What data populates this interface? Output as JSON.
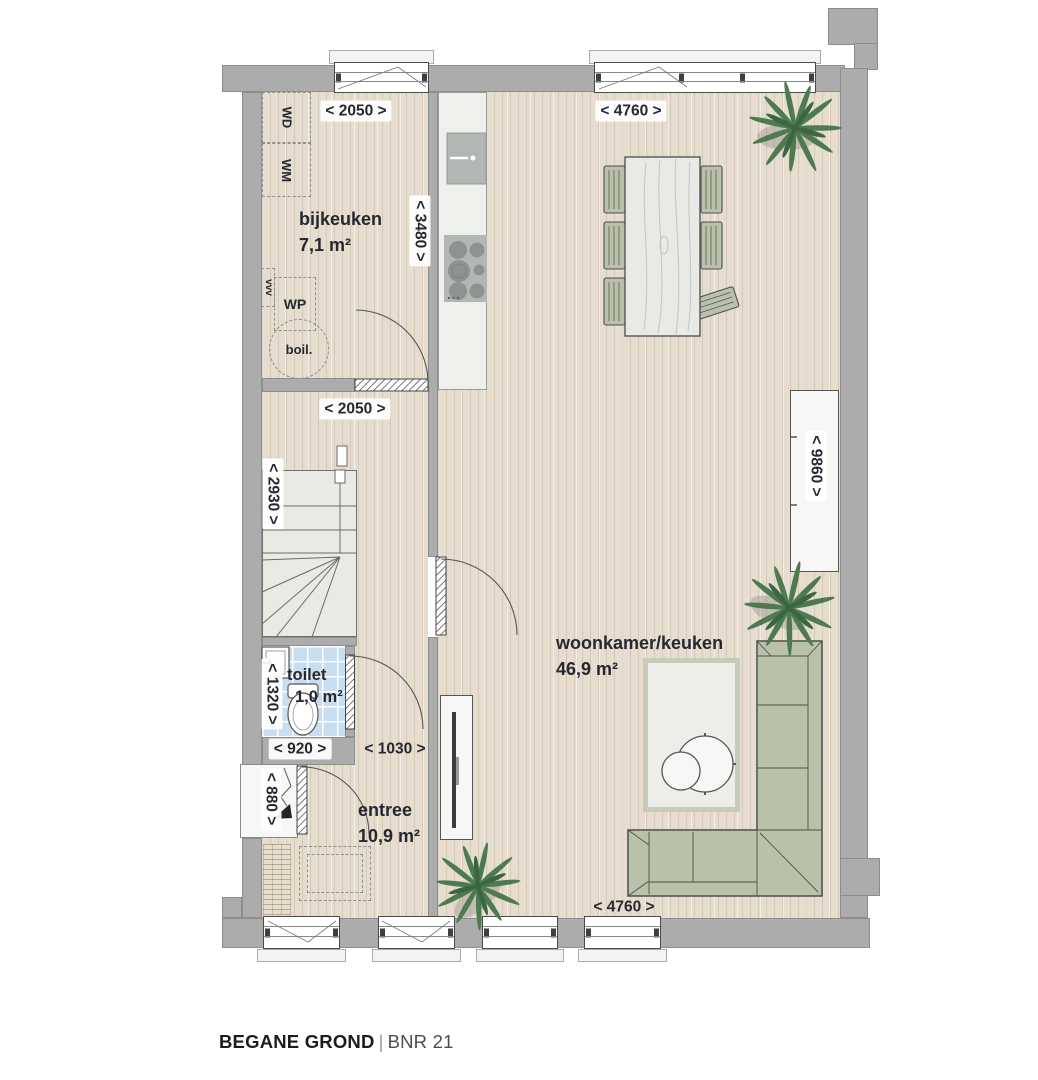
{
  "title": {
    "floor": "BEGANE GROND",
    "separator": "|",
    "unit": "BNR 21"
  },
  "rooms": {
    "bijkeuken": {
      "name": "bijkeuken",
      "area": "7,1 m²"
    },
    "woonkamer": {
      "name": "woonkamer/keuken",
      "area": "46,9 m²"
    },
    "toilet": {
      "name": "toilet",
      "area": "1,0 m²"
    },
    "entree": {
      "name": "entree",
      "area": "10,9 m²"
    }
  },
  "dims": {
    "bijkeuken_width": "< 2050 >",
    "woonkamer_top_width": "< 4760 >",
    "kitchen_depth": "< 3480 >",
    "hall_width": "< 2050 >",
    "stairs_depth": "< 2930 >",
    "room_depth": "< 9860 >",
    "toilet_depth": "< 1320 >",
    "toilet_width": "< 920 >",
    "hall_passage": "< 1030 >",
    "entrance_width": "< 880 >",
    "woonkamer_bottom_width": "< 4760 >"
  },
  "labels": {
    "wd": "WD",
    "wm": "WM",
    "wp": "WP",
    "vent": "vvv",
    "boiler": "boil."
  },
  "colors": {
    "wall": "#acacac",
    "floor": "#e6ddcf",
    "floorLine": "rgba(122,100,74,0.16)",
    "tile": "#c9def0",
    "stairs": "#ebe9e3",
    "counter": "#eef0ec",
    "appliance": "#b3b7b4",
    "burner": "#8f9390",
    "furn": "#b9c1a8",
    "furnLine": "#4f4f4f",
    "wood": "#e9e9e5",
    "white": "#f7f7f5",
    "rugBorder": "#c7ccb8",
    "rug": "#edeeea",
    "plant": "#4d7a4f",
    "plantDark": "#3c6642",
    "text": "#27272f",
    "titleSub": "#4d4d4d"
  }
}
